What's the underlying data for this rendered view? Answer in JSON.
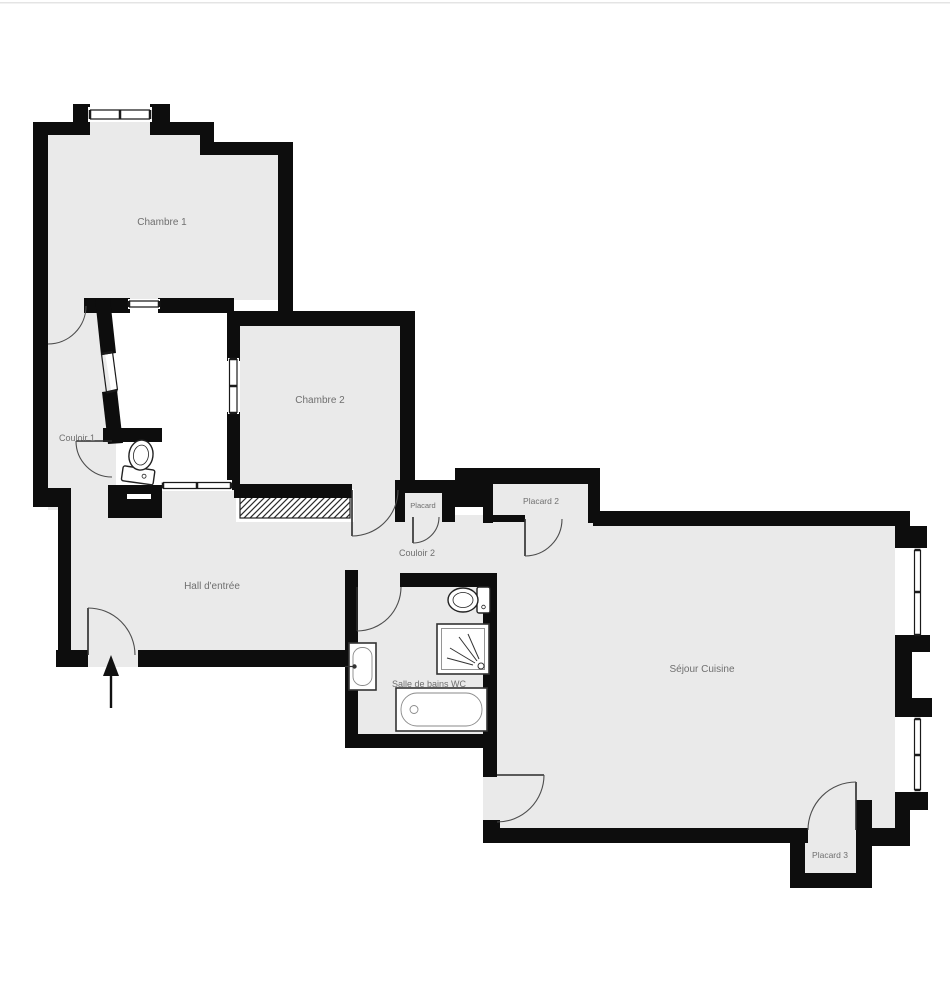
{
  "plan": {
    "rooms": [
      {
        "id": "chambre-1",
        "label": "Chambre 1"
      },
      {
        "id": "chambre-2",
        "label": "Chambre 2"
      },
      {
        "id": "couloir-1",
        "label": "Couloir 1"
      },
      {
        "id": "couloir-2",
        "label": "Couloir 2"
      },
      {
        "id": "hall-entree",
        "label": "Hall d'entrée"
      },
      {
        "id": "salle-de-bains",
        "label": "Salle de bains WC"
      },
      {
        "id": "sejour-cuisine",
        "label": "Séjour Cuisine"
      },
      {
        "id": "placard",
        "label": "Placard"
      },
      {
        "id": "placard-2",
        "label": "Placard 2"
      },
      {
        "id": "placard-3",
        "label": "Placard 3"
      }
    ],
    "fixtures": [
      "toilet-wc",
      "toilet-bathroom",
      "shower",
      "sink",
      "bathtub"
    ],
    "entrance_arrow_direction": "up",
    "colors": {
      "wall": "#0d0d0d",
      "floor": "#eaeaea",
      "outside": "#ffffff",
      "label": "#6f6f6f",
      "hatch": "#2a2a2a"
    }
  }
}
